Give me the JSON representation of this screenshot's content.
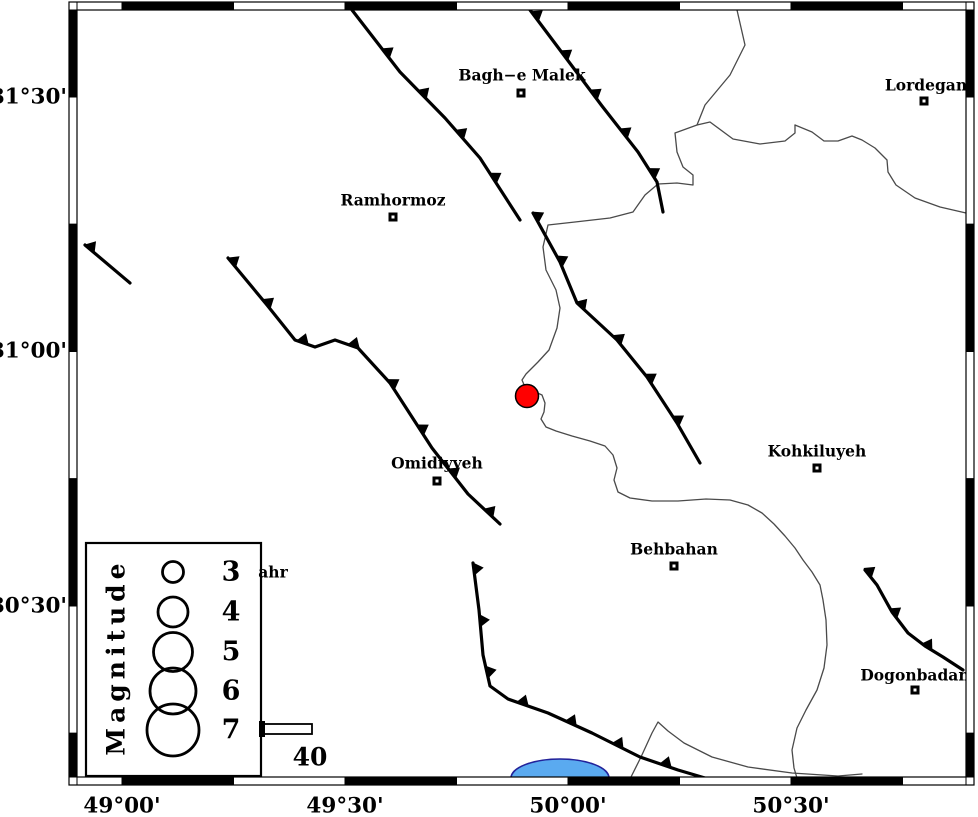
{
  "map": {
    "width": 978,
    "height": 817,
    "background": "#ffffff",
    "frame": {
      "interior": {
        "x1": 77,
        "y1": 10,
        "x2": 966,
        "y2": 777
      },
      "band_thickness": 8,
      "x_boundaries": [
        77,
        122,
        233.5,
        345,
        456.5,
        568,
        679.5,
        791,
        902.5,
        966
      ],
      "y_boundaries": [
        10,
        97,
        224.25,
        351.5,
        478.75,
        606,
        733.25,
        777
      ],
      "x_ticks": [
        {
          "label": "49°00'",
          "px": 122
        },
        {
          "label": "49°30'",
          "px": 345
        },
        {
          "label": "50°00'",
          "px": 568
        },
        {
          "label": "50°30'",
          "px": 791
        }
      ],
      "y_ticks": [
        {
          "label": "31°30'",
          "py": 97
        },
        {
          "label": "31°00'",
          "py": 351
        },
        {
          "label": "30°30'",
          "py": 606
        }
      ]
    }
  },
  "colors": {
    "fault": "#000000",
    "river": "#4a4a4a",
    "lake_fill": "#5aaaf0",
    "lake_stroke": "#22229a",
    "epicenter_fill": "#ff0000",
    "epicenter_stroke": "#000000"
  },
  "epicenter": {
    "x": 527,
    "y": 396,
    "radius": 11.5
  },
  "cities": [
    {
      "name": "Bagh−e Malek",
      "label": [
        522,
        75
      ],
      "marker": [
        521,
        93
      ]
    },
    {
      "name": "Lordegan",
      "label": [
        926,
        85
      ],
      "marker": [
        924,
        101
      ]
    },
    {
      "name": "Ramhormoz",
      "label": [
        393,
        200
      ],
      "marker": [
        393,
        217
      ]
    },
    {
      "name": "Omidiyyeh",
      "label": [
        437,
        463
      ],
      "marker": [
        437,
        481
      ]
    },
    {
      "name": "Kohkiluyeh",
      "label": [
        817,
        451
      ],
      "marker": [
        817,
        468
      ]
    },
    {
      "name": "Behbahan",
      "label": [
        674,
        549
      ],
      "marker": [
        674,
        566
      ]
    },
    {
      "name": "Dogonbadan",
      "label": [
        915,
        675
      ],
      "marker": [
        915,
        690
      ]
    }
  ],
  "partial_label": {
    "text": "ahr",
    "x": 273,
    "y": 572
  },
  "legend": {
    "title": "Magnitude",
    "box": {
      "x": 86,
      "y": 543,
      "w": 175,
      "h": 233
    },
    "title_pos": {
      "x": 116,
      "y": 657
    },
    "circle_x": 173,
    "value_x": 231,
    "items": [
      {
        "magnitude": "3",
        "cy": 572,
        "radius": 10.5
      },
      {
        "magnitude": "4",
        "cy": 612,
        "radius": 15
      },
      {
        "magnitude": "5",
        "cy": 652,
        "radius": 19.5
      },
      {
        "magnitude": "6",
        "cy": 691,
        "radius": 23
      },
      {
        "magnitude": "7",
        "cy": 730,
        "radius": 26
      }
    ]
  },
  "scale_bar": {
    "label": "40",
    "x": 262,
    "y": 724,
    "w": 50,
    "h": 10,
    "label_pos": [
      310,
      757
    ]
  },
  "faults": [
    {
      "id": "fault-nw-long",
      "points": [
        [
          352,
          10
        ],
        [
          400,
          72
        ],
        [
          445,
          118
        ],
        [
          480,
          158
        ],
        [
          520,
          220
        ]
      ],
      "spacing": 55,
      "offset": 55
    },
    {
      "id": "fault-bagh-e-malek",
      "points": [
        [
          530,
          10
        ],
        [
          566,
          58
        ],
        [
          602,
          106
        ],
        [
          638,
          152
        ],
        [
          657,
          182
        ],
        [
          663,
          212
        ]
      ],
      "spacing": 49,
      "offset": 8
    },
    {
      "id": "fault-central",
      "points": [
        [
          533,
          213
        ],
        [
          560,
          262
        ],
        [
          577,
          303
        ],
        [
          617,
          340
        ],
        [
          647,
          377
        ],
        [
          677,
          423
        ],
        [
          700,
          463
        ]
      ],
      "spacing": 50,
      "offset": 5
    },
    {
      "id": "fault-west-stub",
      "points": [
        [
          85,
          245
        ],
        [
          130,
          283
        ]
      ],
      "spacing": 100,
      "offset": 6
    },
    {
      "id": "fault-omidiyyeh",
      "points": [
        [
          228,
          258
        ],
        [
          267,
          305
        ],
        [
          295,
          340
        ],
        [
          315,
          347
        ],
        [
          335,
          340
        ],
        [
          358,
          348
        ],
        [
          390,
          383
        ],
        [
          432,
          448
        ],
        [
          468,
          494
        ],
        [
          500,
          524
        ]
      ],
      "spacing": 54,
      "offset": 6
    },
    {
      "id": "fault-south-bend",
      "points": [
        [
          473,
          563
        ],
        [
          479,
          610
        ],
        [
          483,
          655
        ],
        [
          490,
          686
        ],
        [
          508,
          699
        ],
        [
          548,
          713
        ],
        [
          592,
          733
        ],
        [
          640,
          757
        ],
        [
          678,
          770
        ],
        [
          705,
          778
        ]
      ],
      "spacing": 52,
      "offset": 6
    },
    {
      "id": "fault-dogonbadan",
      "points": [
        [
          865,
          570
        ],
        [
          877,
          585
        ],
        [
          892,
          612
        ],
        [
          908,
          633
        ],
        [
          925,
          646
        ],
        [
          943,
          657
        ],
        [
          963,
          670
        ]
      ],
      "spacing": 48,
      "offset": 4
    }
  ],
  "rivers": [
    {
      "id": "river-main",
      "points": [
        [
          737,
          10
        ],
        [
          745,
          45
        ],
        [
          730,
          75
        ],
        [
          705,
          105
        ],
        [
          697,
          125
        ],
        [
          675,
          133
        ],
        [
          677,
          152
        ],
        [
          683,
          167
        ],
        [
          693,
          175
        ],
        [
          693,
          185
        ],
        [
          677,
          183
        ],
        [
          658,
          184
        ],
        [
          645,
          195
        ],
        [
          633,
          212
        ],
        [
          610,
          218
        ],
        [
          575,
          222
        ],
        [
          548,
          225
        ],
        [
          543,
          247
        ],
        [
          546,
          270
        ],
        [
          556,
          290
        ],
        [
          560,
          308
        ],
        [
          557,
          328
        ],
        [
          549,
          350
        ],
        [
          538,
          362
        ],
        [
          526,
          374
        ],
        [
          522,
          380
        ],
        [
          525,
          387
        ],
        [
          533,
          391
        ],
        [
          542,
          395
        ],
        [
          545,
          403
        ],
        [
          544,
          412
        ],
        [
          541,
          419
        ],
        [
          546,
          427
        ],
        [
          556,
          431
        ],
        [
          572,
          436
        ],
        [
          590,
          441
        ],
        [
          605,
          446
        ],
        [
          613,
          455
        ],
        [
          617,
          468
        ],
        [
          614,
          480
        ],
        [
          618,
          492
        ],
        [
          630,
          498
        ],
        [
          652,
          501
        ],
        [
          678,
          501
        ],
        [
          706,
          499
        ],
        [
          730,
          500
        ],
        [
          748,
          505
        ],
        [
          762,
          513
        ],
        [
          774,
          524
        ],
        [
          785,
          536
        ],
        [
          795,
          548
        ],
        [
          803,
          560
        ],
        [
          812,
          572
        ],
        [
          820,
          585
        ],
        [
          823,
          600
        ],
        [
          826,
          620
        ],
        [
          827,
          645
        ],
        [
          824,
          668
        ],
        [
          817,
          690
        ],
        [
          806,
          710
        ],
        [
          797,
          728
        ],
        [
          792,
          750
        ],
        [
          794,
          768
        ],
        [
          797,
          778
        ]
      ]
    },
    {
      "id": "river-meander",
      "points": [
        [
          697,
          125
        ],
        [
          710,
          122
        ],
        [
          733,
          139
        ],
        [
          760,
          144
        ],
        [
          785,
          141
        ],
        [
          795,
          133
        ],
        [
          795,
          125
        ]
      ]
    },
    {
      "id": "river-lordegan",
      "points": [
        [
          795,
          125
        ],
        [
          812,
          132
        ],
        [
          824,
          141
        ],
        [
          838,
          141
        ],
        [
          852,
          136
        ],
        [
          862,
          140
        ],
        [
          875,
          148
        ],
        [
          887,
          160
        ],
        [
          888,
          172
        ],
        [
          896,
          185
        ],
        [
          915,
          198
        ],
        [
          940,
          207
        ],
        [
          966,
          213
        ]
      ]
    },
    {
      "id": "river-south",
      "points": [
        [
          630,
          779
        ],
        [
          641,
          757
        ],
        [
          652,
          733
        ],
        [
          658,
          722
        ],
        [
          668,
          731
        ],
        [
          684,
          743
        ],
        [
          712,
          757
        ],
        [
          748,
          767
        ],
        [
          792,
          773
        ],
        [
          838,
          776
        ],
        [
          862,
          774
        ]
      ]
    }
  ],
  "lake": {
    "cx": 560,
    "base_y": 778,
    "rx": 49,
    "ry": 19
  }
}
